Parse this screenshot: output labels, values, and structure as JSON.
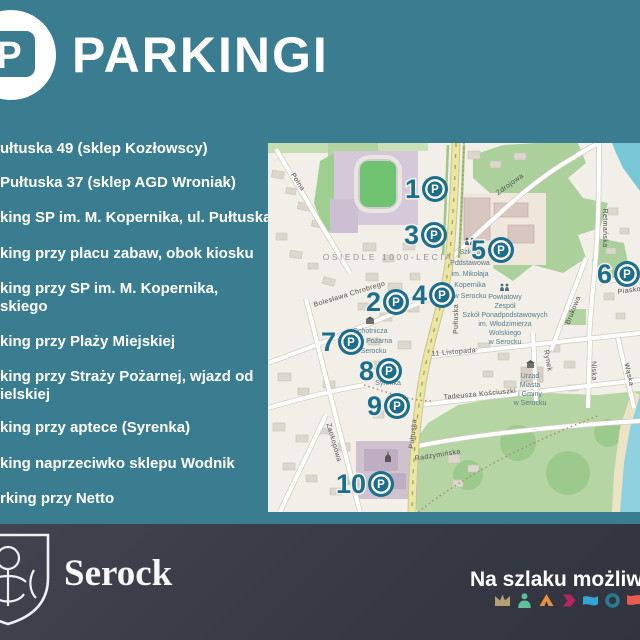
{
  "theme": {
    "background_teal": "#3a7d91",
    "footer_dark": "#383b46",
    "marker_teal": "#1d6d8d",
    "map_background": "#f2efe8",
    "text_white": "#ffffff"
  },
  "header": {
    "logo_letter": "P",
    "title": "PARKINGI"
  },
  "parking_list": [
    {
      "lines": [
        "ułtuska 49 (sklep Kozłowscy)"
      ]
    },
    {
      "lines": [
        "Pułtuska 37 (sklep AGD Wroniak)"
      ]
    },
    {
      "lines": [
        "king SP im. M. Kopernika, ul. Pułtuska"
      ]
    },
    {
      "lines": [
        "king przy placu zabaw, obok kiosku"
      ]
    },
    {
      "lines": [
        "king przy SP im. M. Kopernika,",
        "skiego"
      ]
    },
    {
      "lines": [
        "king przy Plaży Miejskiej"
      ]
    },
    {
      "lines": [
        "king przy Straży Pożarnej, wjazd od",
        "ielskiej"
      ]
    },
    {
      "lines": [
        "king przy aptece (Syrenka)"
      ]
    },
    {
      "lines": [
        "king naprzeciwko sklepu Wodnik"
      ]
    },
    {
      "lines": [
        "rking przy Netto"
      ]
    }
  ],
  "map": {
    "area_label": "OSIEDLE 1000-LECIA",
    "streets": {
      "polna": "Polna",
      "boleslawa_chrobrego": "Bolesława Chrobrego",
      "pultuska_upper": "Pułtuska",
      "pultuska_lower": "Pułtuska",
      "zdrojowa": "Zdrojowa",
      "retmanska": "Retmańska",
      "listopada_11": "11 Listopada",
      "kosciuszki": "Tadeusza Kościuszki",
      "zaokopowa": "Zaokopowa",
      "radzyminska": "Radzymińska",
      "rynek": "Rynek",
      "niska": "Niska",
      "waska": "Wąska",
      "brukowa": "Brukowa",
      "piaskowa": "Piaskowa"
    },
    "pois": {
      "school_podstawowa": [
        "Szkoła",
        "Podstawowa",
        "im. Mikołaja",
        "Kopernika",
        "w Serocku"
      ],
      "zespol_szkol": [
        "Powiatowy",
        "Zespół",
        "Szkół Ponadpodstawowych",
        "im. Włodzimierza",
        "Wolskiego",
        "w Serocku"
      ],
      "straz_pozarna": [
        "Ochotnicza",
        "Straż Pożarna",
        "w Serocku"
      ],
      "urzad_miasta": [
        "Urząd",
        "Miasta",
        "i Gminy",
        "w Serocku"
      ],
      "syrenka": "Syrenka"
    },
    "markers": [
      {
        "number": "1"
      },
      {
        "number": "2"
      },
      {
        "number": "3"
      },
      {
        "number": "4"
      },
      {
        "number": "5"
      },
      {
        "number": "6"
      },
      {
        "number": "7"
      },
      {
        "number": "8"
      },
      {
        "number": "9"
      },
      {
        "number": "10"
      }
    ]
  },
  "footer": {
    "city": "Serock",
    "slogan": "Na szlaku możliwości",
    "icons": [
      "crown-m",
      "person",
      "tent",
      "arrow-right",
      "flag",
      "ring",
      "banner"
    ]
  }
}
